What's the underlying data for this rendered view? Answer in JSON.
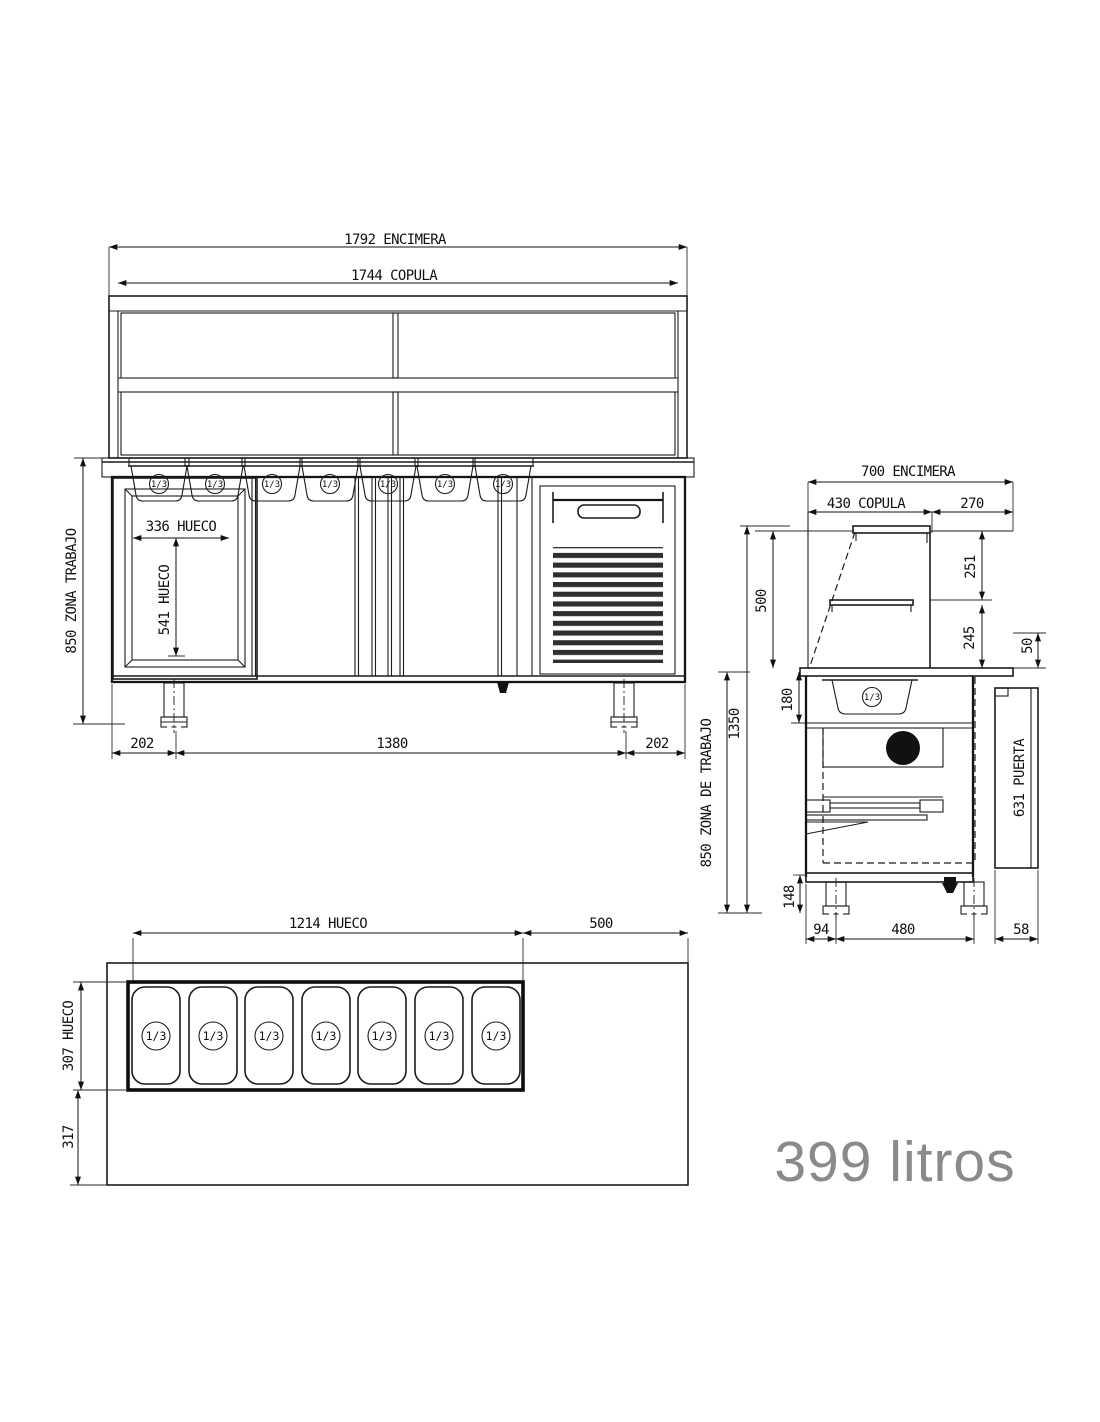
{
  "title": "Plano tecnico mostrador refrigerado con copula",
  "capacity_label": "399 litros",
  "pan_size_label": "1/3",
  "colors": {
    "line": "#1c1c1c",
    "text": "#101010",
    "capacity_text": "#8a8a8a",
    "background": "#ffffff"
  },
  "front_view": {
    "encimera_width": "1792 ENCIMERA",
    "copula_width": "1744 COPULA",
    "hueco_width": "336 HUECO",
    "hueco_height": "541 HUECO",
    "work_zone": "850 ZONA TRABAJO",
    "foot_left": "202",
    "leg_span": "1380",
    "foot_right": "202"
  },
  "side_view": {
    "encimera_depth": "700 ENCIMERA",
    "copula_depth": "430 COPULA",
    "rear_flat": "270",
    "copula_height": "500",
    "total_height": "1350",
    "upper_gap": "251",
    "lower_gap": "245",
    "lip": "50",
    "pan_zone": "180",
    "work_zone": "850 ZONA DE TRABAJO",
    "door": "631 PUERTA",
    "leg_height": "148",
    "front_offset": "94",
    "leg_span": "480",
    "door_offset": "58"
  },
  "plan_view": {
    "hueco_width": "1214 HUECO",
    "rear_depth": "500",
    "hueco_depth": "307 HUECO",
    "front_depth": "317"
  }
}
